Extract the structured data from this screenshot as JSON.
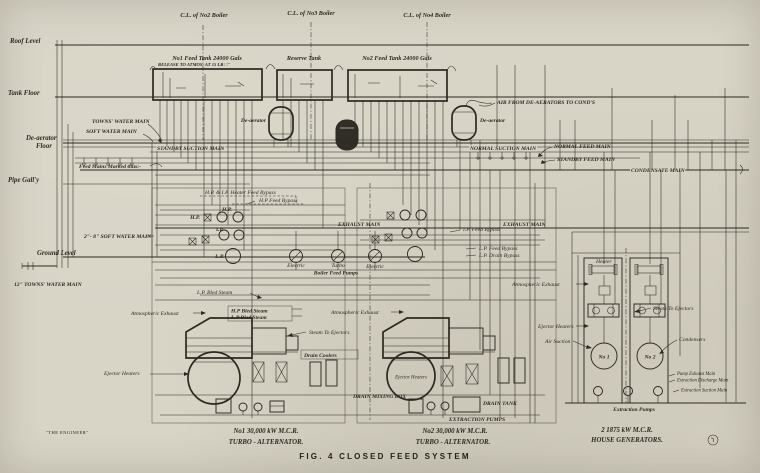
{
  "colors": {
    "paper": "#d8d4c6",
    "ink": "#2b2921"
  },
  "header": {
    "cl_no2": "C.L. of No2 Boiler",
    "cl_no3": "C.L. of No3 Boiler",
    "cl_no4": "C.L. of No4 Boiler"
  },
  "levels": {
    "roof": "Roof Level",
    "tank_floor": "Tank Floor",
    "deaerator_line1": "De-aerator",
    "deaerator_line2": "Floor",
    "pipe_gallery": "Pipe Gall'y",
    "ground": "Ground Level"
  },
  "tanks": {
    "no1_label": "No1 Feed Tank 24000 Gals",
    "no1_release": "RELEASE TO ATMOS: AT 15 LB □\"",
    "reserve_label": "Reserve Tank",
    "no2_label": "No2 Feed Tank 24000 Gals"
  },
  "deaerators": {
    "left": "De-aerator",
    "right": "De-aerator"
  },
  "mains": {
    "towns_water": "TOWNS' WATER MAIN",
    "soft_water": "SOFT WATER MAIN",
    "standby_suction": "STANDBY SUCTION MAIN",
    "normal_suction": "NORMAL SUCTION MAIN",
    "normal_feed": "NORMAL FEED MAIN",
    "standby_feed": "STANDBY FEED MAIN",
    "condensate": "CONDENSATE MAIN",
    "air_from_deaerators": "AIR FROM DE-AERATORS TO COND'S",
    "exhaust_center": "EXHAUST MAIN",
    "exhaust_right": "EXHAUST MAIN",
    "feed_marked": "Feed Mains Marked thus:-",
    "soft_water_2_8": "2\"- 8\" SOFT WATER MAIN",
    "towns_water_12": "12\" TOWNS' WATER MAIN"
  },
  "heaters": {
    "bypass_hp_ip": "H.P. & I.P. Heater Feed Bypass",
    "bypass_hp": "H.P Feed Bypass",
    "bypass_ip": "I.P. Feed Bypass",
    "bypass_lp_feed": "L.P. Feed Bypass",
    "bypass_lp_drain": "L.P. Drain Bypass",
    "hp_left": "H.P.",
    "hp_top": "H.P.",
    "ip": "I.P.",
    "lp": "L.P."
  },
  "feed_pumps": {
    "electric_1": "Electric",
    "turbo": "Turbo",
    "electric_2": "Electric",
    "group": "Boiler Feed Pumps"
  },
  "steam": {
    "lp_bled": "L.P. Bled Steam",
    "hp_bled": "H.P Bled Steam",
    "lp_bled_2": "L.P Bled Steam",
    "atmos_left": "Atmospheric Exhaust",
    "atmos_center": "Atmospheric Exhaust",
    "atmos_right": "Atmospheric Exhaust",
    "to_ejectors_left": "Steam To Ejectors",
    "to_ejectors_right": "Steam To Ejectors",
    "drain_coolers": "Drain Coolers",
    "ejector_heaters_left": "Ejector Heaters",
    "ejector_heaters_mid": "Ejector Heaters",
    "ejector_heaters_right": "Ejector Heaters",
    "air_suction": "Air Suction"
  },
  "house": {
    "heater": "Heater",
    "condensers": "Condensers",
    "no1": "No 1",
    "no2": "No 2",
    "pump_exhaust_main": "Pump Exhaust Main",
    "extraction_discharge_main": "Extraction Discharge Main",
    "extraction_suction_main": "Extraction Suction Main",
    "extraction_pumps": "Extraction Pumps"
  },
  "bottom": {
    "drain_mixing_box": "DRAIN MIXING BOX",
    "drain_tank": "DRAIN TANK",
    "extraction_pumps_label": "EXTRACTION PUMPS",
    "unit1_line1": "No1 30,000 kW M.C.R.",
    "unit1_line2": "TURBO - ALTERNATOR.",
    "unit2_line1": "No2 30,000 kW M.C.R.",
    "unit2_line2": "TURBO - ALTERNATOR.",
    "house_line1": "2  1875 kW M.C.R.",
    "house_line2": "HOUSE GENERATORS.",
    "caption": "FIG. 4  CLOSED FEED SYSTEM",
    "source": "\"THE ENGINEER\""
  }
}
